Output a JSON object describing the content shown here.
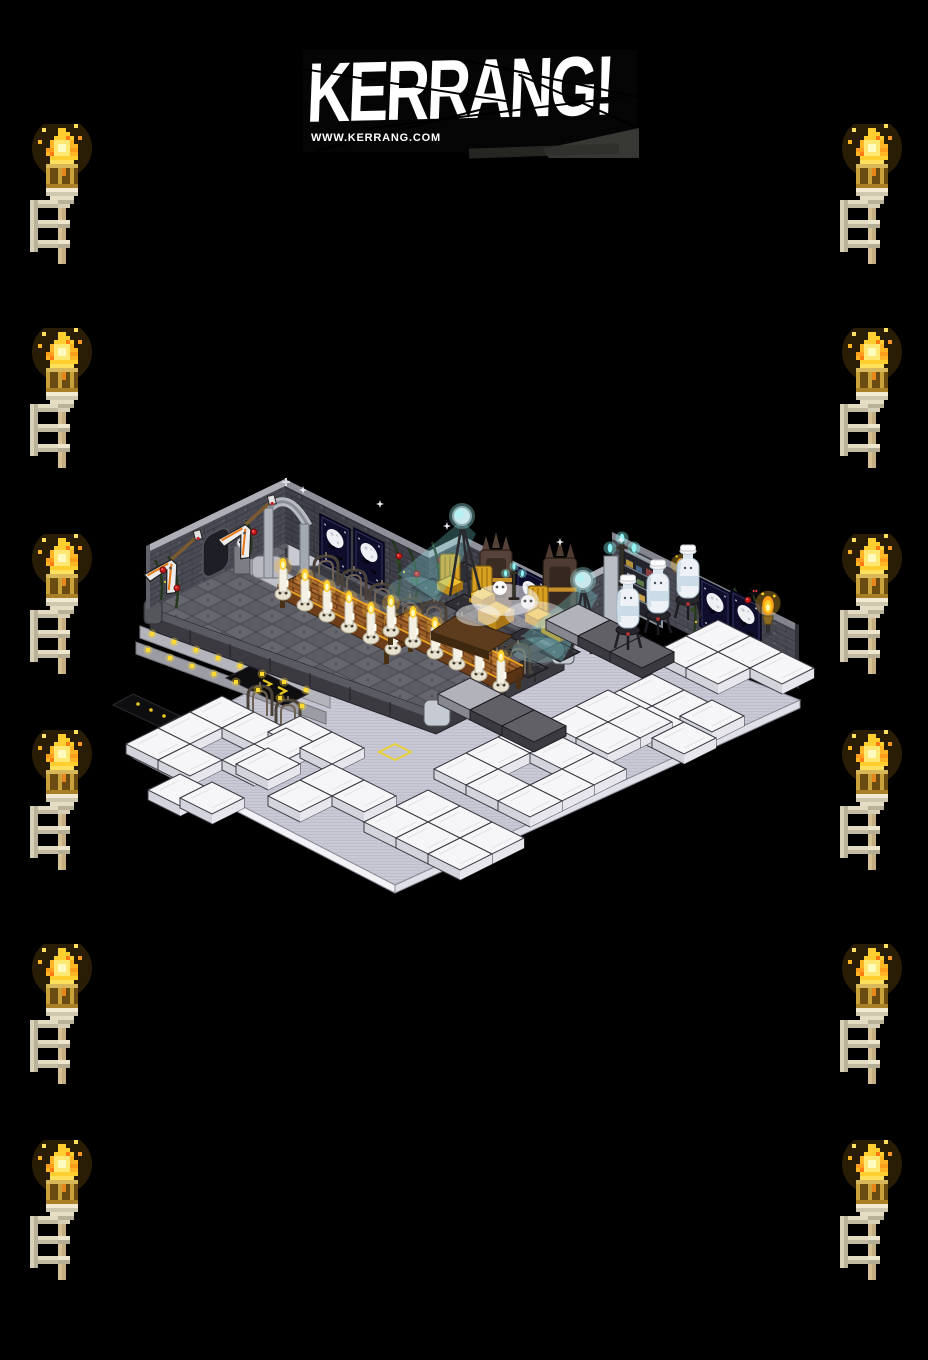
{
  "logo": {
    "title": "KERRANG!",
    "website": "WWW.KERRANG.COM",
    "icon": "kerrang-logo",
    "text_color": "#ffffff",
    "background_color": "#000000"
  },
  "palette": {
    "page_bg": "#000000",
    "flame_gold": "#ffd22a",
    "flame_orange": "#ff9e14",
    "beam_teal": "#82e0e4",
    "floor_lavender": "#c9c9d6",
    "stage_cobble": "#60606a",
    "wall_charcoal": "#46464f",
    "poster_navy": "#0e0e2c",
    "cursor_yellow": "#e8d23c",
    "block_white": "#f6f6f8",
    "table_wood": "#9a5f28",
    "rose_red": "#c81a1a"
  },
  "torches": {
    "icon": "wall-torch-icon",
    "left_x": 30,
    "right_x": 840,
    "ys": [
      124,
      328,
      534,
      730,
      944,
      1140
    ]
  },
  "room": {
    "cursor_tile": {
      "x": 395,
      "y": 752,
      "icon": "tile-cursor"
    },
    "layers": [
      {
        "layer": "speaker-tiles",
        "def": "#def-speaker-tile",
        "name": "stage-speaker-tile",
        "interactable": "true",
        "items": [
          [
            432,
            588
          ],
          [
            464,
            604
          ],
          [
            496,
            620
          ],
          [
            528,
            636
          ],
          [
            464,
            572
          ],
          [
            496,
            588
          ],
          [
            528,
            604
          ],
          [
            560,
            620
          ],
          [
            560,
            652
          ],
          [
            528,
            668
          ],
          [
            496,
            652
          ]
        ]
      },
      {
        "layer": "wall-items-posters",
        "def": "#def-poster",
        "name": "moon-bats-poster",
        "interactable": "true",
        "skewY": 26.5,
        "items": [
          [
            320,
            514
          ],
          [
            354,
            528
          ],
          [
            516,
            566
          ],
          [
            700,
            578
          ],
          [
            731,
            590
          ]
        ]
      },
      {
        "layer": "wall-items-guitars",
        "def": "#def-guitar",
        "name": "flying-v-guitar",
        "interactable": "true",
        "rot": -14,
        "items": [
          [
            170,
            562
          ],
          [
            244,
            527
          ]
        ]
      },
      {
        "layer": "wall-items-roses",
        "def": "#def-rose",
        "name": "rose-vine-bloom",
        "interactable": "false",
        "items": [
          [
            163,
            570
          ],
          [
            177,
            588
          ],
          [
            254,
            532
          ],
          [
            399,
            556
          ],
          [
            417,
            574
          ],
          [
            441,
            560
          ],
          [
            452,
            585
          ],
          [
            692,
            602
          ],
          [
            748,
            600
          ]
        ]
      },
      {
        "layer": "wall-items-spiders",
        "def": "#def-spider",
        "name": "spider-decoration",
        "interactable": "false",
        "items": [
          [
            620,
            594
          ],
          [
            694,
            598
          ],
          [
            755,
            592
          ]
        ]
      },
      {
        "layer": "candles-table1",
        "def": "#def-candle",
        "name": "skull-candle",
        "interactable": "true",
        "items": [
          [
            283,
            594
          ],
          [
            305,
            605
          ],
          [
            327,
            616
          ],
          [
            349,
            627
          ],
          [
            371,
            638
          ],
          [
            393,
            649
          ]
        ]
      },
      {
        "layer": "candles-table2",
        "def": "#def-candle",
        "name": "skull-candle",
        "interactable": "true",
        "items": [
          [
            391,
            631
          ],
          [
            413,
            642
          ],
          [
            435,
            653
          ],
          [
            457,
            664
          ],
          [
            479,
            675
          ],
          [
            501,
            686
          ]
        ]
      },
      {
        "layer": "gold-chairs",
        "def": "#def-gold-chair",
        "name": "gold-chair",
        "interactable": "true",
        "items": [
          [
            450,
            594
          ],
          [
            482,
            606
          ],
          [
            538,
            626
          ]
        ]
      },
      {
        "layer": "candelabras",
        "def": "#def-candelabra",
        "name": "teal-candelabra",
        "interactable": "true",
        "items": [
          [
            622,
            586
          ],
          [
            514,
            600,
            0.7
          ]
        ]
      },
      {
        "layer": "wall-torches",
        "def": "#def-wall-torch",
        "name": "gold-wall-torch",
        "interactable": "false",
        "items": [
          [
            681,
            576,
            0.85
          ],
          [
            768,
            618,
            1.05
          ]
        ]
      },
      {
        "layer": "step-lights",
        "def": "#def-step-light",
        "name": "stage-edge-light",
        "interactable": "false",
        "items": [
          [
            152,
            634
          ],
          [
            174,
            642
          ],
          [
            196,
            650
          ],
          [
            218,
            658
          ],
          [
            240,
            666
          ],
          [
            262,
            674
          ],
          [
            284,
            682
          ],
          [
            306,
            690
          ],
          [
            148,
            650
          ],
          [
            170,
            658
          ],
          [
            192,
            666
          ],
          [
            214,
            674
          ],
          [
            236,
            682
          ],
          [
            258,
            690
          ],
          [
            280,
            698
          ],
          [
            302,
            706
          ]
        ]
      },
      {
        "layer": "white-blocks",
        "def": "#def-white-block",
        "name": "white-cushion-block",
        "interactable": "true",
        "sortY": true,
        "items": [
          [
            222,
            712
          ],
          [
            190,
            728
          ],
          [
            254,
            728
          ],
          [
            158,
            744
          ],
          [
            286,
            744
          ],
          [
            190,
            760
          ],
          [
            254,
            760
          ],
          [
            180,
            790
          ],
          [
            212,
            798
          ],
          [
            300,
            732
          ],
          [
            332,
            748
          ],
          [
            268,
            764
          ],
          [
            332,
            780
          ],
          [
            300,
            796
          ],
          [
            364,
            796
          ],
          [
            428,
            806
          ],
          [
            396,
            822
          ],
          [
            460,
            822
          ],
          [
            428,
            838
          ],
          [
            492,
            838
          ],
          [
            460,
            854
          ],
          [
            530,
            737
          ],
          [
            498,
            753
          ],
          [
            562,
            753
          ],
          [
            466,
            769
          ],
          [
            594,
            769
          ],
          [
            498,
            785
          ],
          [
            562,
            785
          ],
          [
            530,
            801
          ],
          [
            652,
            690
          ],
          [
            620,
            706
          ],
          [
            684,
            706
          ],
          [
            652,
            722
          ],
          [
            712,
            716
          ],
          [
            684,
            738
          ],
          [
            718,
            636
          ],
          [
            686,
            652
          ],
          [
            750,
            652
          ],
          [
            718,
            668
          ],
          [
            782,
            668
          ],
          [
            608,
            706
          ],
          [
            640,
            722
          ],
          [
            576,
            722
          ],
          [
            608,
            738
          ]
        ]
      },
      {
        "layer": "benches-light",
        "def": "#def-bench-light",
        "name": "gray-bench-block",
        "interactable": "true",
        "items": [
          [
            578,
            620
          ],
          [
            470,
            694
          ]
        ]
      },
      {
        "layer": "benches-dark",
        "def": "#def-bench-dark",
        "name": "dark-bench-block",
        "interactable": "true",
        "items": [
          [
            610,
            636
          ],
          [
            642,
            652
          ],
          [
            502,
            710
          ],
          [
            534,
            726
          ]
        ]
      },
      {
        "layer": "figures",
        "def": "#def-figure",
        "name": "white-bottle-avatar",
        "interactable": "true",
        "items": [
          [
            628,
            640
          ],
          [
            658,
            625
          ],
          [
            688,
            610
          ]
        ]
      },
      {
        "layer": "sparkles",
        "def": "#def-sparkle",
        "name": "sparkle-glint",
        "interactable": "false",
        "items": [
          [
            303,
            490
          ],
          [
            447,
            526
          ],
          [
            560,
            542
          ],
          [
            621,
            540
          ],
          [
            380,
            504
          ]
        ]
      }
    ]
  }
}
